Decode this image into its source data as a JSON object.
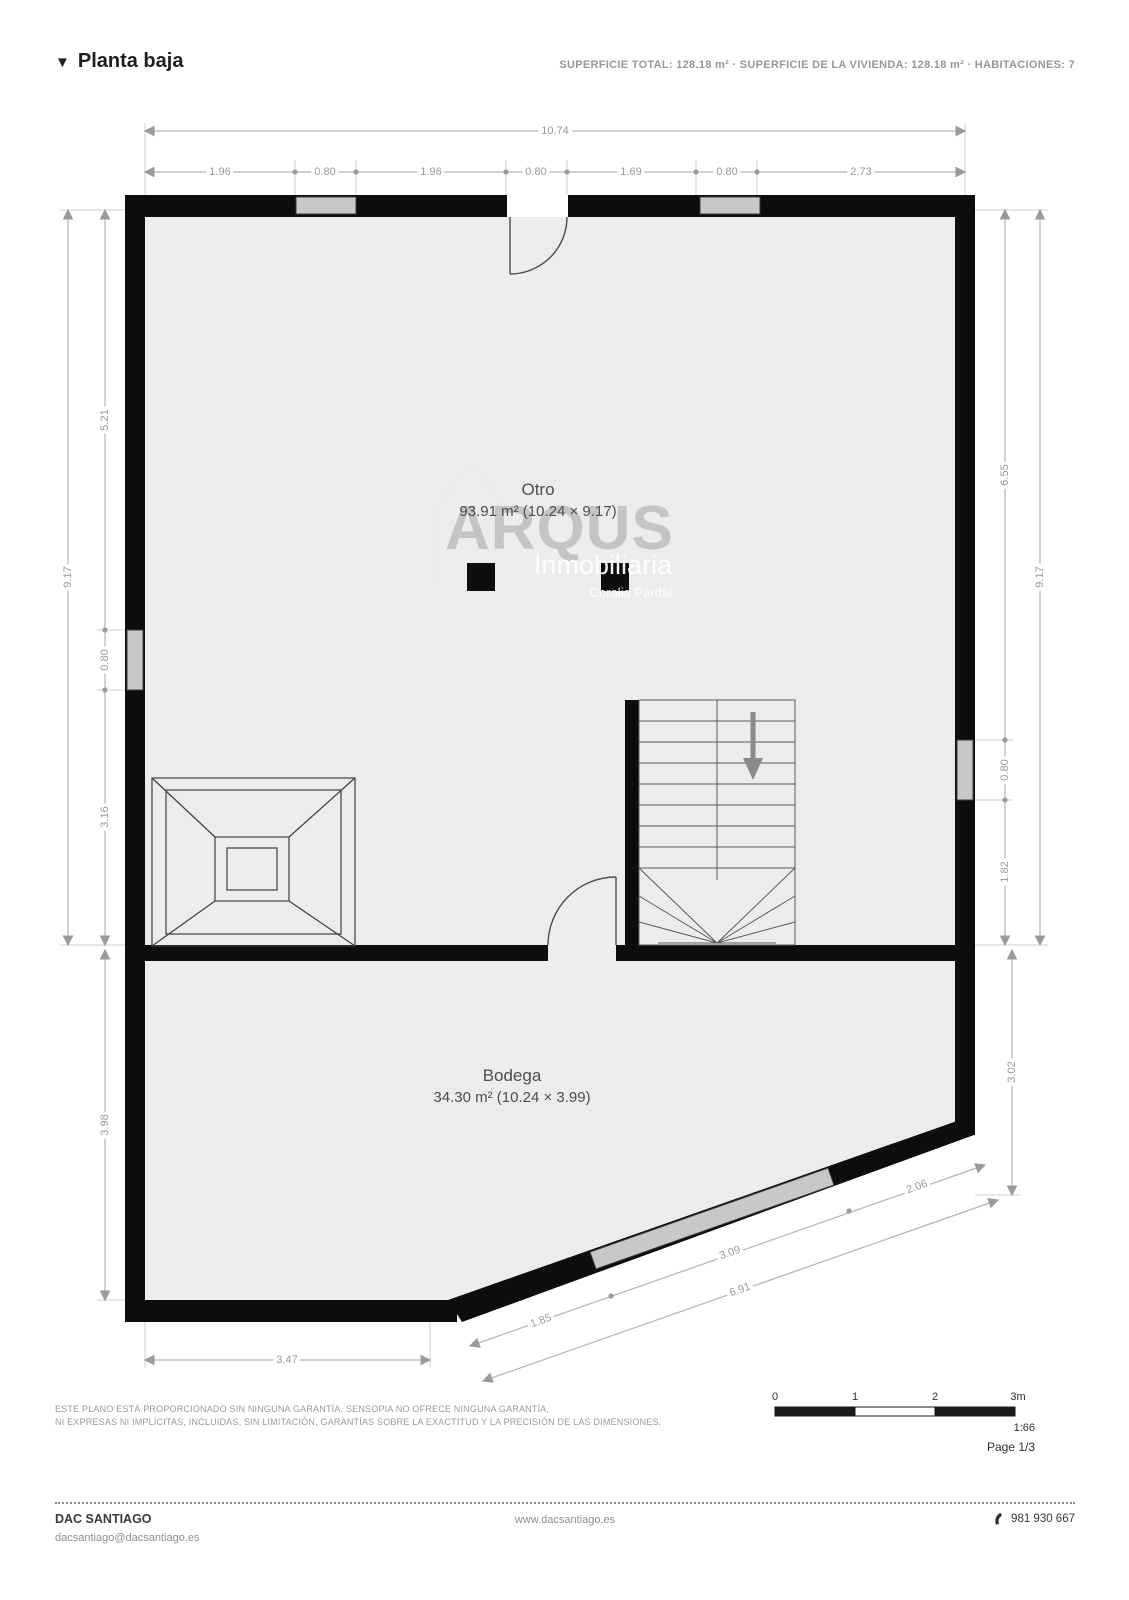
{
  "header": {
    "marker": "▼",
    "title": "Planta baja",
    "summary": "SUPERFICIE TOTAL: 128.18 m² · SUPERFICIE DE LA VIVIENDA: 128.18 m² · HABITACIONES: 7"
  },
  "rooms": {
    "otro": {
      "name": "Otro",
      "area": "93.91 m² (10.24 × 9.17)"
    },
    "bodega": {
      "name": "Bodega",
      "area": "34.30 m² (10.24 × 3.99)"
    }
  },
  "dims": {
    "top_total": "10.74",
    "top_segments": [
      "1.96",
      "0.80",
      "1.96",
      "0.80",
      "1.69",
      "0.80",
      "2.73"
    ],
    "left_total": "9.17",
    "left_segments": [
      "5.21",
      "0.80",
      "3.16"
    ],
    "left_lower": "3.98",
    "right_total": "9.17",
    "right_segments": [
      "6.55",
      "0.80",
      "1.82"
    ],
    "right_lower": "3.02",
    "bottom_left": "3.47",
    "diag_segments": [
      "1.85",
      "3.09",
      "2.06"
    ],
    "diag_total": "6.91"
  },
  "watermark": {
    "brand": "ARQUS",
    "subtitle": "Inmobiliaria",
    "agent": "Coralia Pardal"
  },
  "scale_bar": {
    "ticks": [
      "0",
      "1",
      "2",
      "3m"
    ],
    "ratio": "1:66",
    "page": "Page 1/3"
  },
  "disclaimer": {
    "line1": "ESTE PLANO ESTÁ PROPORCIONADO SIN NINGUNA GARANTÍA. SENSOPIA NO OFRECE NINGUNA GARANTÍA,",
    "line2": "NI EXPRESAS NI IMPLÍCITAS, INCLUIDAS, SIN LIMITACIÓN, GARANTÍAS SOBRE LA EXACTITUD Y LA PRECISIÓN DE LAS DIMENSIONES."
  },
  "footer": {
    "company": "DAC SANTIAGO",
    "email": "dacsantiago@dacsantiago.es",
    "website": "www.dacsantiago.es",
    "phone": "981 930 667"
  }
}
